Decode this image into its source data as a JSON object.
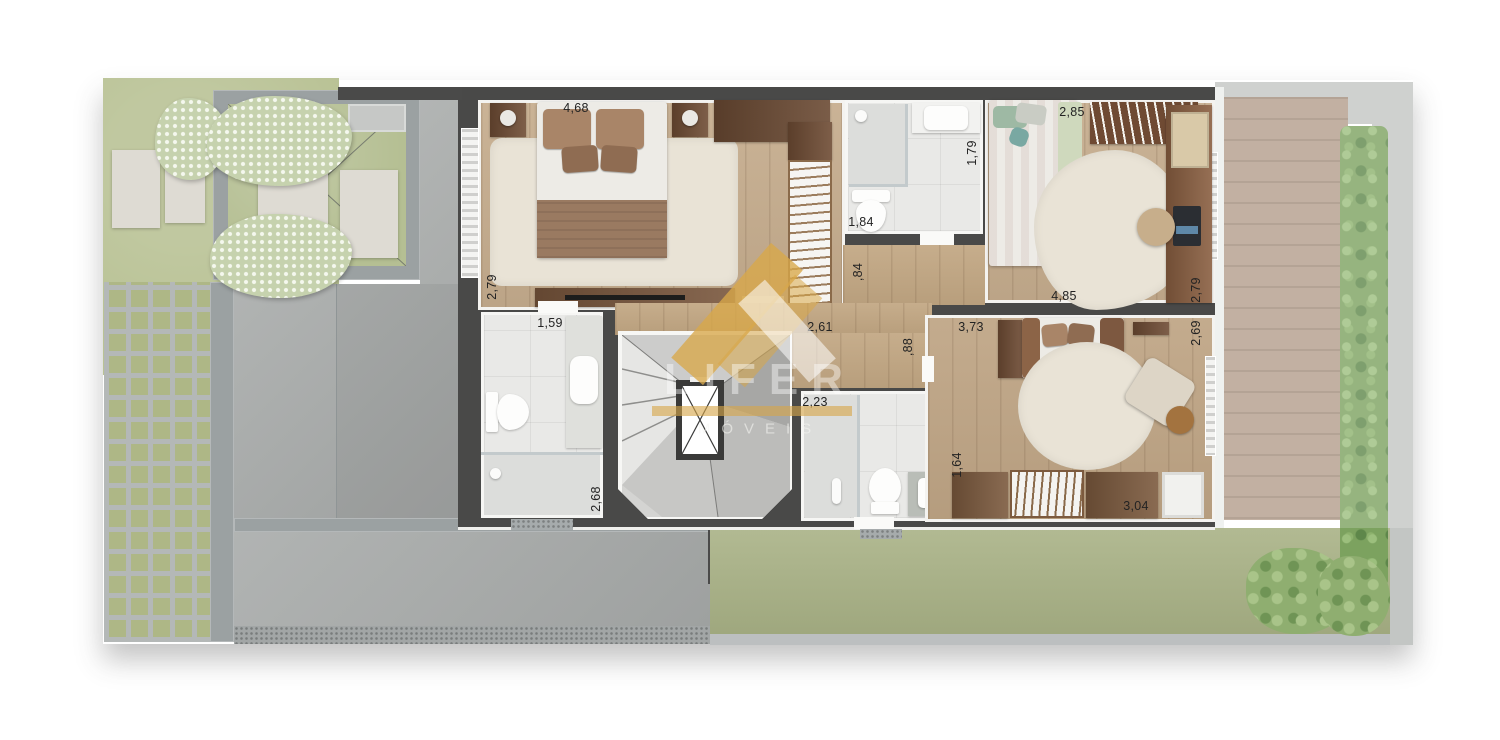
{
  "watermark": {
    "brand": "LIFER",
    "sub": "MÓVEIS",
    "logo_icon": "gold-ribbon-chevron",
    "gold_color": "#d8a849",
    "text_color": "#ffffff"
  },
  "dims": [
    {
      "text": "4,68"
    },
    {
      "text": "2,79"
    },
    {
      "text": "2,61"
    },
    {
      "text": "1,84"
    },
    {
      "text": "1,79"
    },
    {
      "text": ",84"
    },
    {
      "text": "2,85"
    },
    {
      "text": "4,85"
    },
    {
      "text": "2,79"
    },
    {
      "text": ",88"
    },
    {
      "text": "3,73"
    },
    {
      "text": "2,69"
    },
    {
      "text": "3,04"
    },
    {
      "text": "1,64"
    },
    {
      "text": "2,23"
    },
    {
      "text": "1,59"
    },
    {
      "text": "2,68"
    }
  ],
  "colors": {
    "wall": "#494948",
    "wood_floor": "#c6ad8e",
    "tile_floor": "#e9e9e7",
    "concrete": "#a8abaa",
    "grass_left": "#b9c295",
    "grass_right": "#a9b286",
    "deck": "#b39d8b",
    "hedge": "#7ca25f",
    "watermark_gold": "#d8a849"
  }
}
